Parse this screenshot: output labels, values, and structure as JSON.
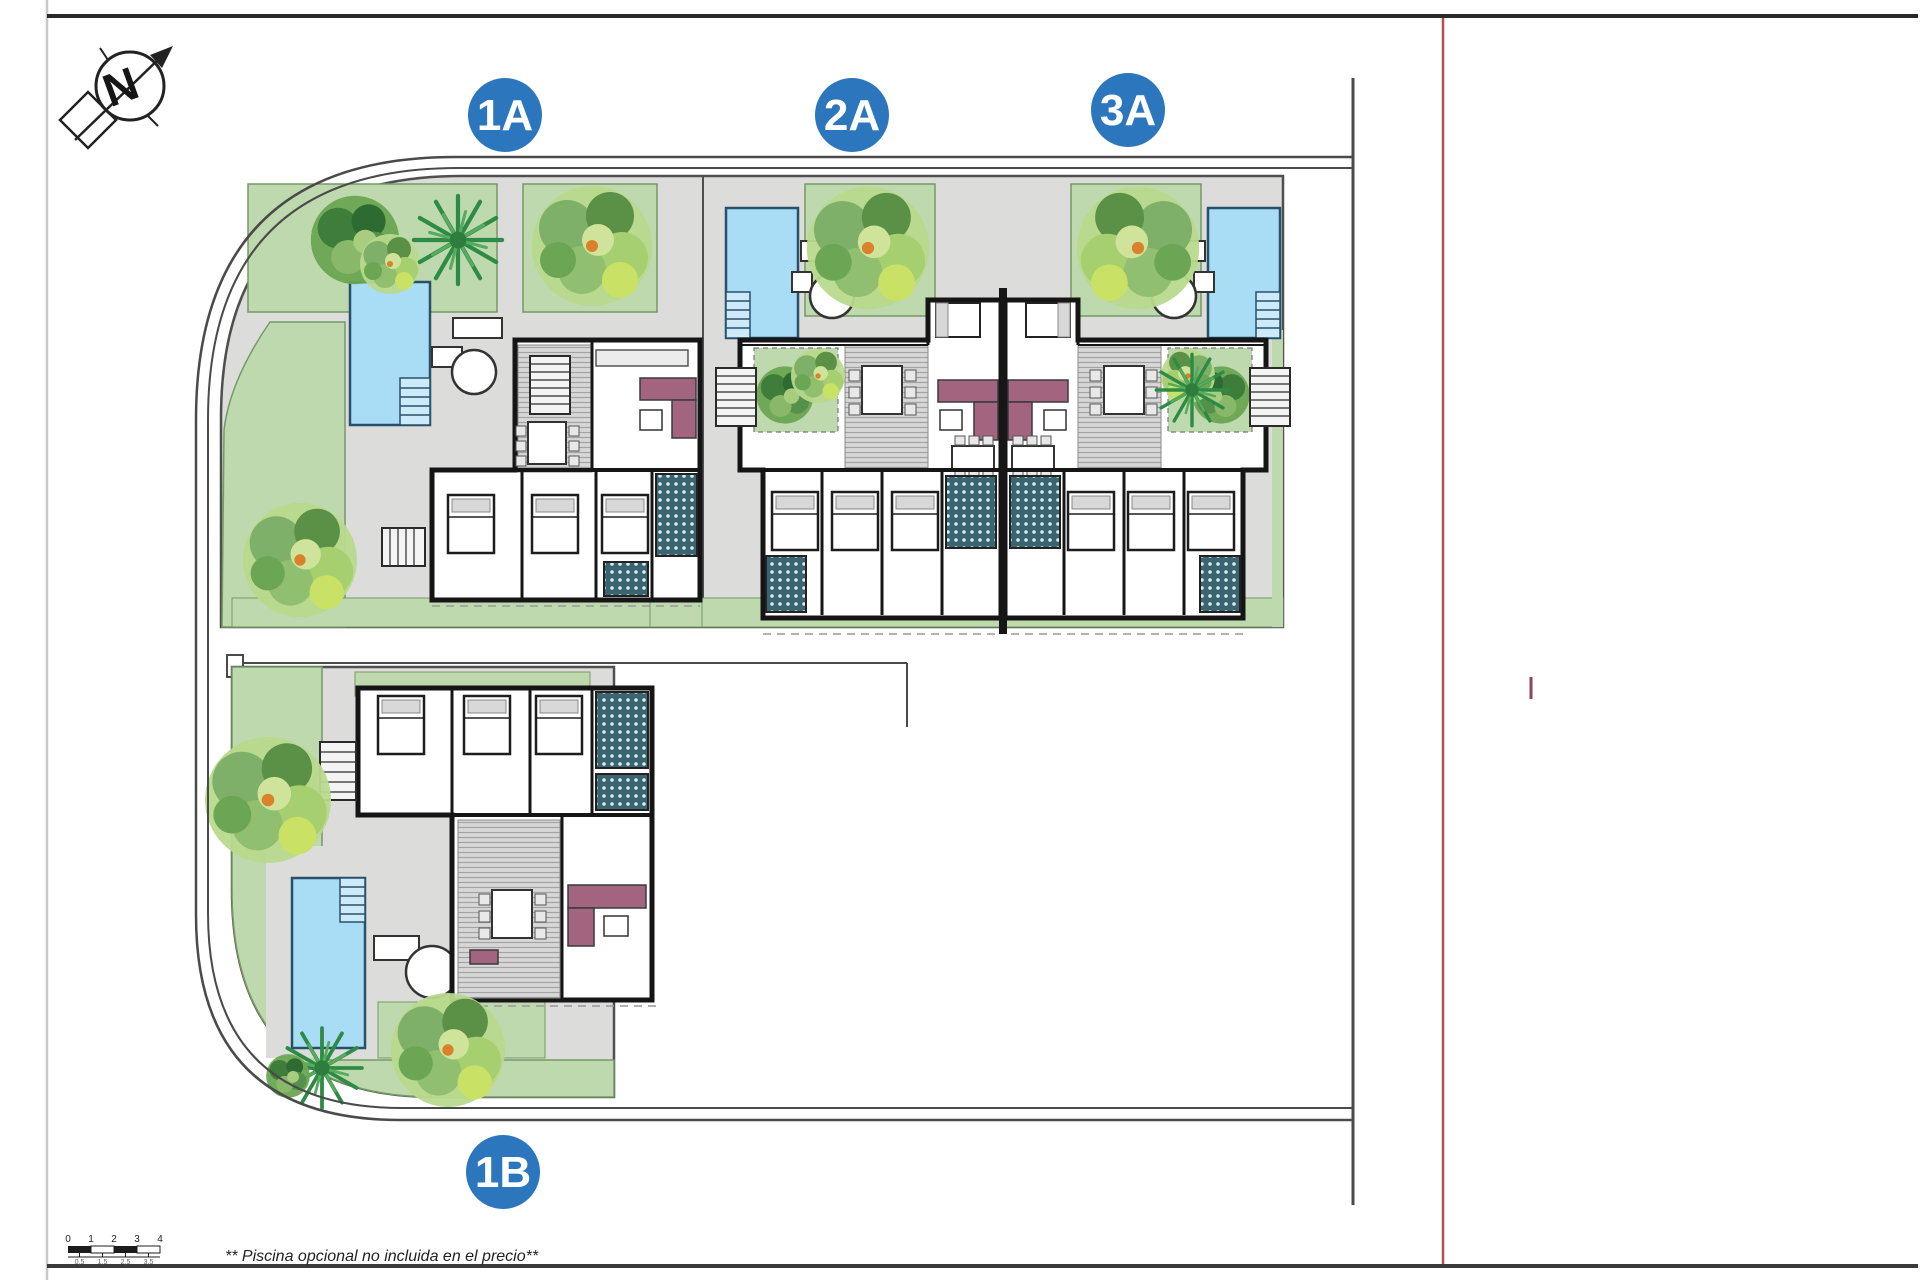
{
  "drawing": {
    "title_hint": "site-plan",
    "north_label": "N",
    "note": "** Piscina opcional no incluida en el precio**"
  },
  "units": [
    {
      "id": "1A",
      "label": "1A"
    },
    {
      "id": "2A",
      "label": "2A"
    },
    {
      "id": "3A",
      "label": "3A"
    },
    {
      "id": "1B",
      "label": "1B"
    }
  ],
  "scale_bar": {
    "major_labels": [
      "0",
      "1",
      "2",
      "3",
      "4"
    ],
    "minor_labels": [
      "0,5",
      "1,5",
      "2,5",
      "3,5"
    ]
  },
  "colors": {
    "badge_blue": "#2b76bd",
    "pool_blue": "#a9dcf5",
    "garden_green": "#bed9ad",
    "paving_gray": "#dcdddb",
    "wall_black": "#161616",
    "sofa_mauve": "#a2647e",
    "road_line": "#4a4a4a",
    "red_reference_line": "#b05050",
    "tree_light": "#b8d98d",
    "tree_dark": "#3e7d3a",
    "tile_teal": "#3a6570"
  }
}
